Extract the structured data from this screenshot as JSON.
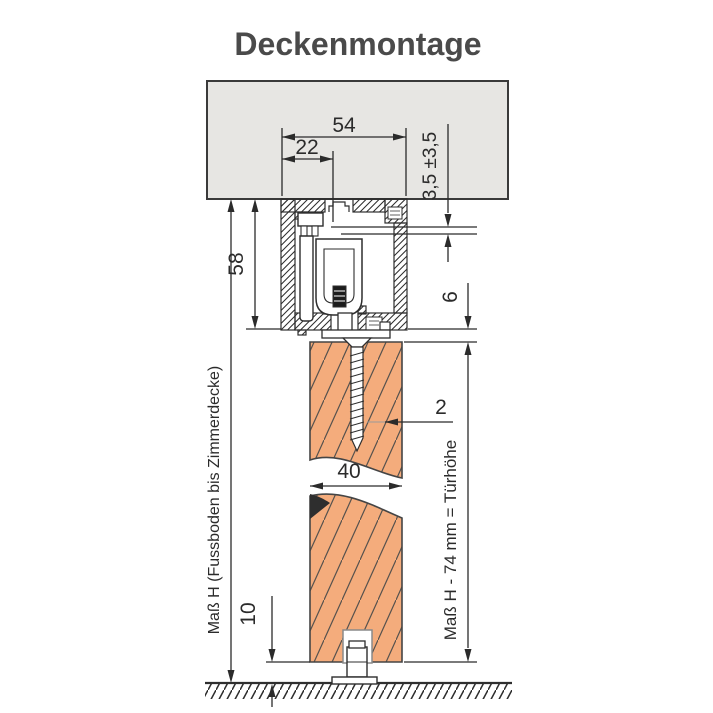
{
  "title": "Deckenmontage",
  "colors": {
    "ceiling_fill": "#e7e6e3",
    "wood_fill": "#f4ac7c",
    "line": "#2e2e2e",
    "title": "#4a4a4a"
  },
  "labels": {
    "track_width": "54",
    "bolt_offset": "22",
    "adjustment_range": "3,5 ±3,5",
    "track_height": "58",
    "gap_track_door": "6",
    "screw_callout": "2",
    "door_thickness": "40",
    "floor_gap": "10",
    "height_left": "Maß H (Fussboden bis Zimmerdecke)",
    "height_right": "Maß H - 74 mm = Türhöhe"
  }
}
